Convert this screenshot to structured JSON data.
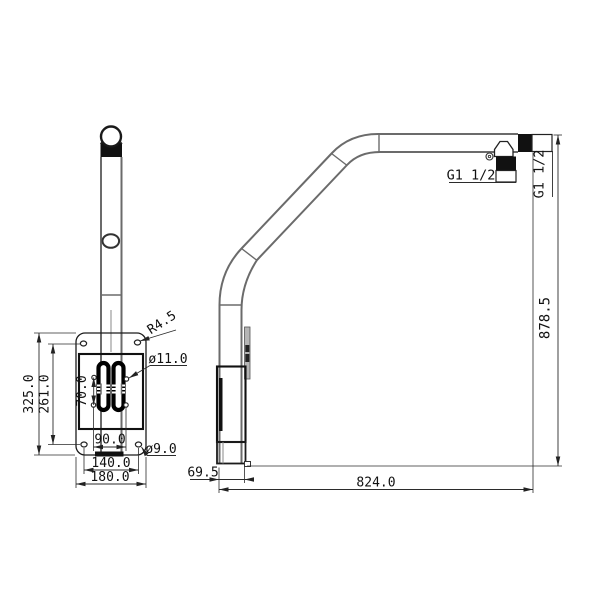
{
  "drawing": {
    "front_view": {
      "plate_height": "325.0",
      "hole_spacing_vertical": "261.0",
      "slot_pitch_vertical": "70.0",
      "slot_pitch_horizontal": "90.0",
      "hole_spacing_horizontal": "140.0",
      "plate_width": "180.0",
      "corner_slot_radius": "R4.5",
      "slot_hole_diameter": "ø11.0",
      "corner_hole_diameter": "ø9.0"
    },
    "side_view": {
      "outlet_thread": "G1 1/2",
      "inlet_thread": "G1 1/2",
      "overall_height": "878.5",
      "horizontal_reach": "824.0",
      "wall_offset": "69.5"
    }
  }
}
